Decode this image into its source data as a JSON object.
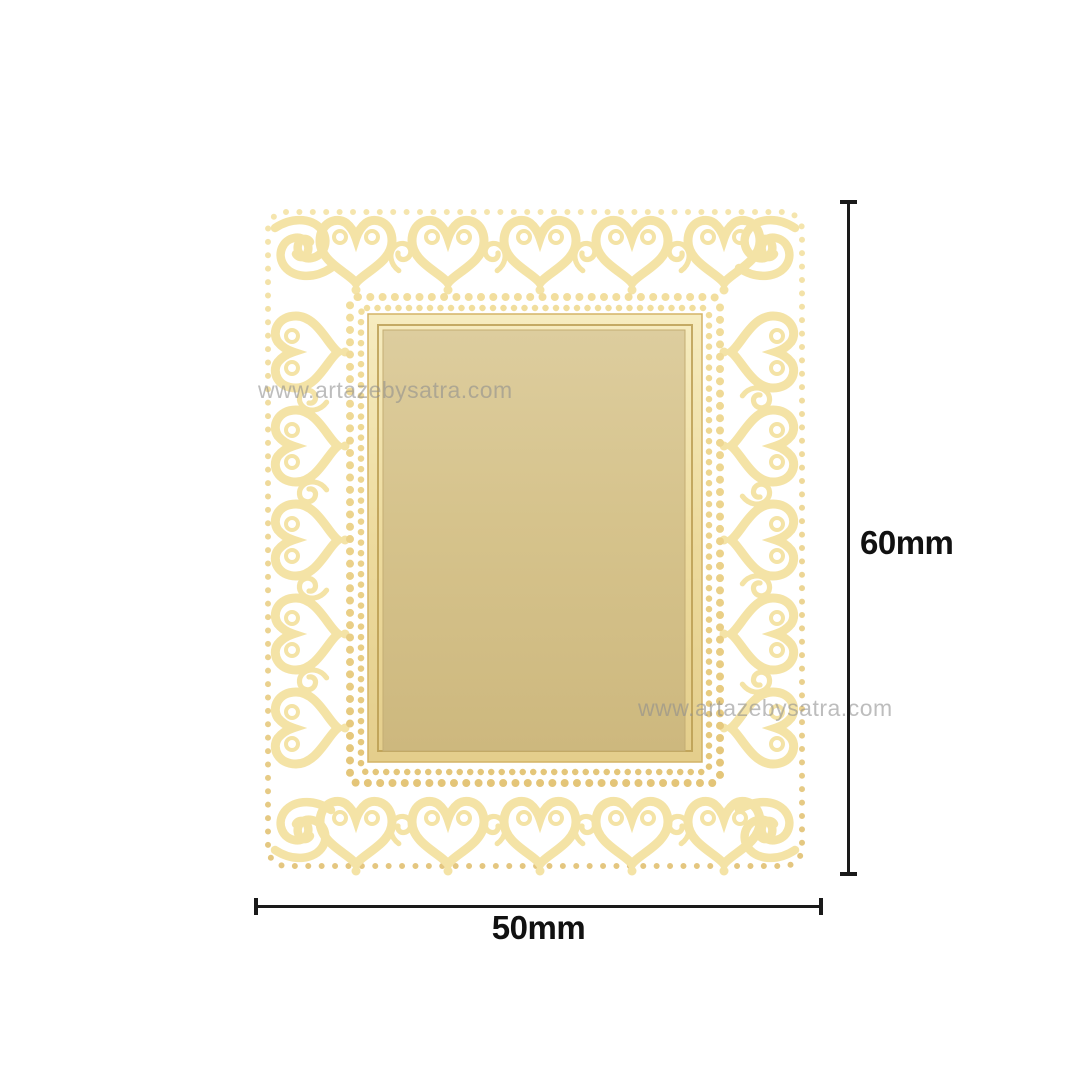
{
  "page": {
    "background_color": "#ffffff",
    "description": "Product dimension image of an ornate gold photo frame with heart and scroll filigree border"
  },
  "product": {
    "name": "ornate-gold-heart-scroll-photo-frame",
    "frame_colors": {
      "gold_highlight": "#f8edba",
      "gold_mid": "#eed792",
      "gold_shadow": "#dfbd6c",
      "bezel_light": "#f5e9bb",
      "panel_light": "#ded0a0",
      "panel_mid": "#d6c38c",
      "panel_dark": "#ccb77d"
    }
  },
  "watermarks": [
    {
      "text": "www.artazebysatra.com"
    },
    {
      "text": "www.artazebysatra.com"
    }
  ],
  "dimensions": {
    "height_label": "60mm",
    "width_label": "50mm",
    "line_color": "#1a1a1a",
    "label_color": "#111111"
  }
}
